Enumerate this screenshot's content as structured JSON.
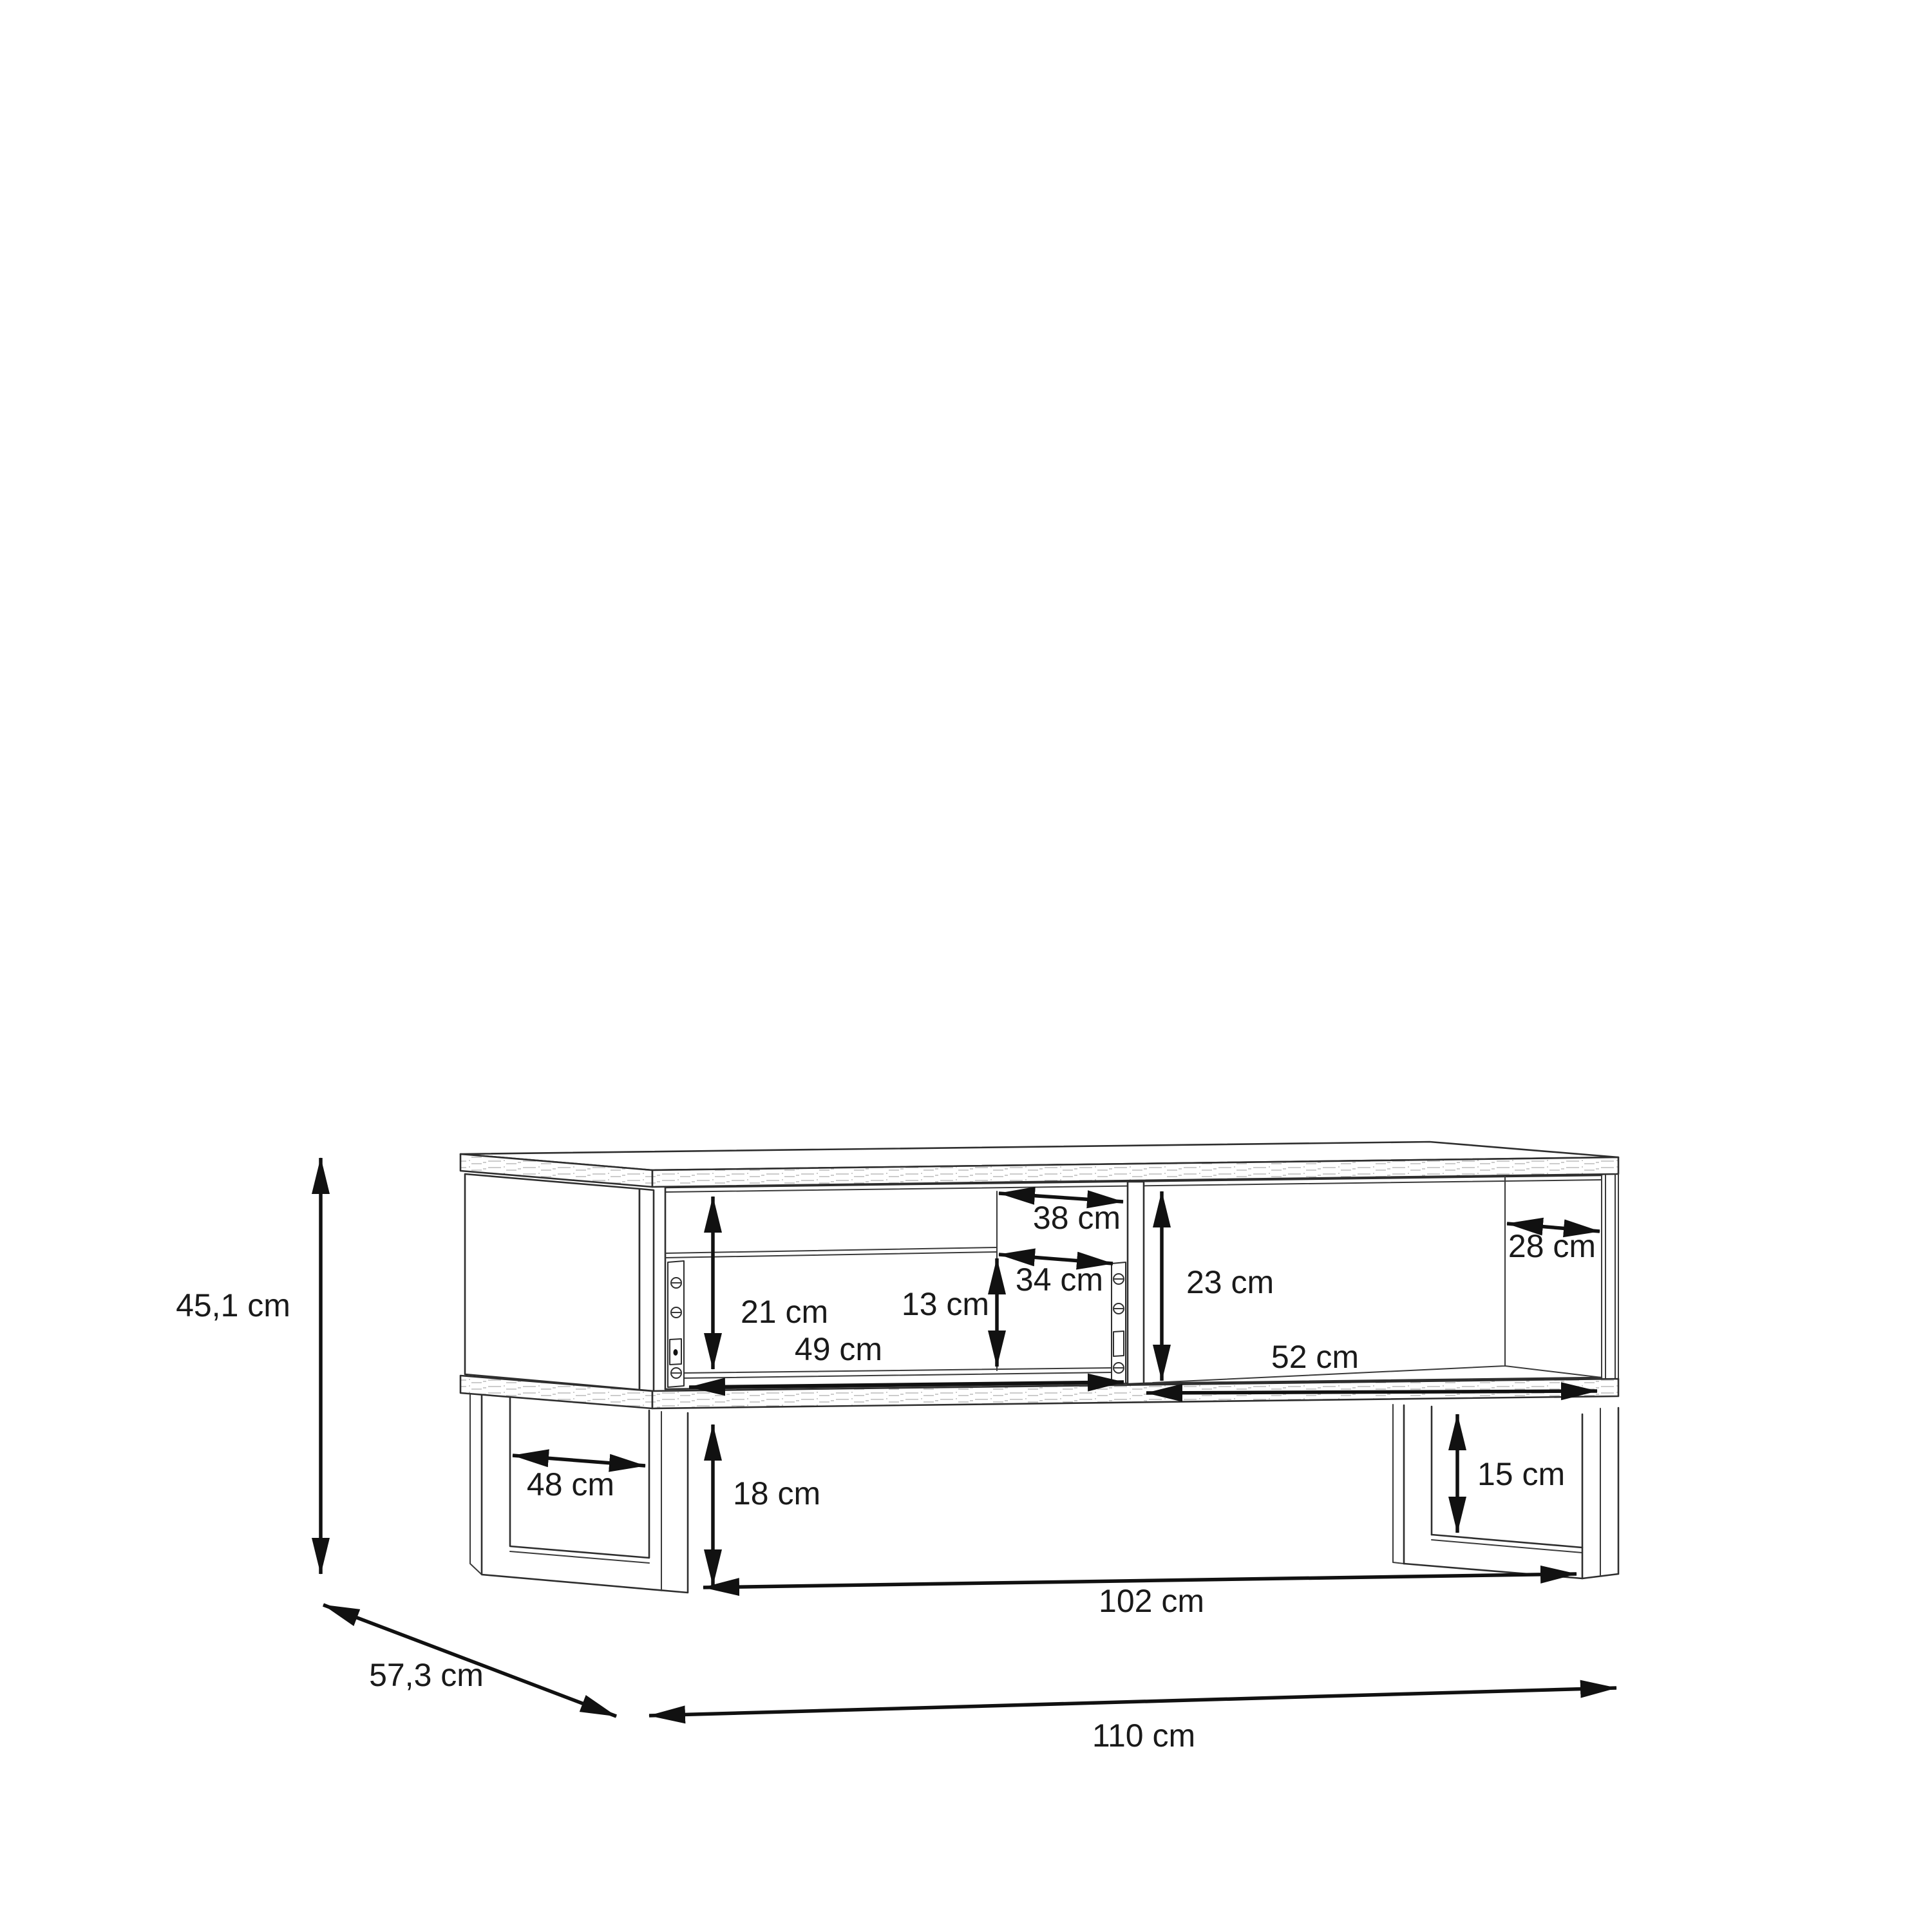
{
  "diagram": {
    "kind": "furniture dimension line drawing",
    "units": "cm",
    "background": "#ffffff",
    "line_color": "#2e2e2e",
    "dimension_color": "#111111",
    "text_color": "#1a1a1a",
    "dimensions": {
      "overall_height": "45,1 cm",
      "overall_depth": "57,3 cm",
      "overall_width": "110 cm",
      "base_width": "102 cm",
      "leg_opening_depth": "48 cm",
      "underbody_clearance": "18 cm",
      "leg_inner_height": "15 cm",
      "left_compartment_height": "21 cm",
      "drawer_inner_height": "13 cm",
      "top_opening_depth": "38 cm",
      "drawer_opening_depth": "34 cm",
      "right_compartment_height": "23 cm",
      "drawer_width": "49 cm",
      "right_compartment_width": "52 cm",
      "right_compartment_depth": "28 cm"
    }
  }
}
